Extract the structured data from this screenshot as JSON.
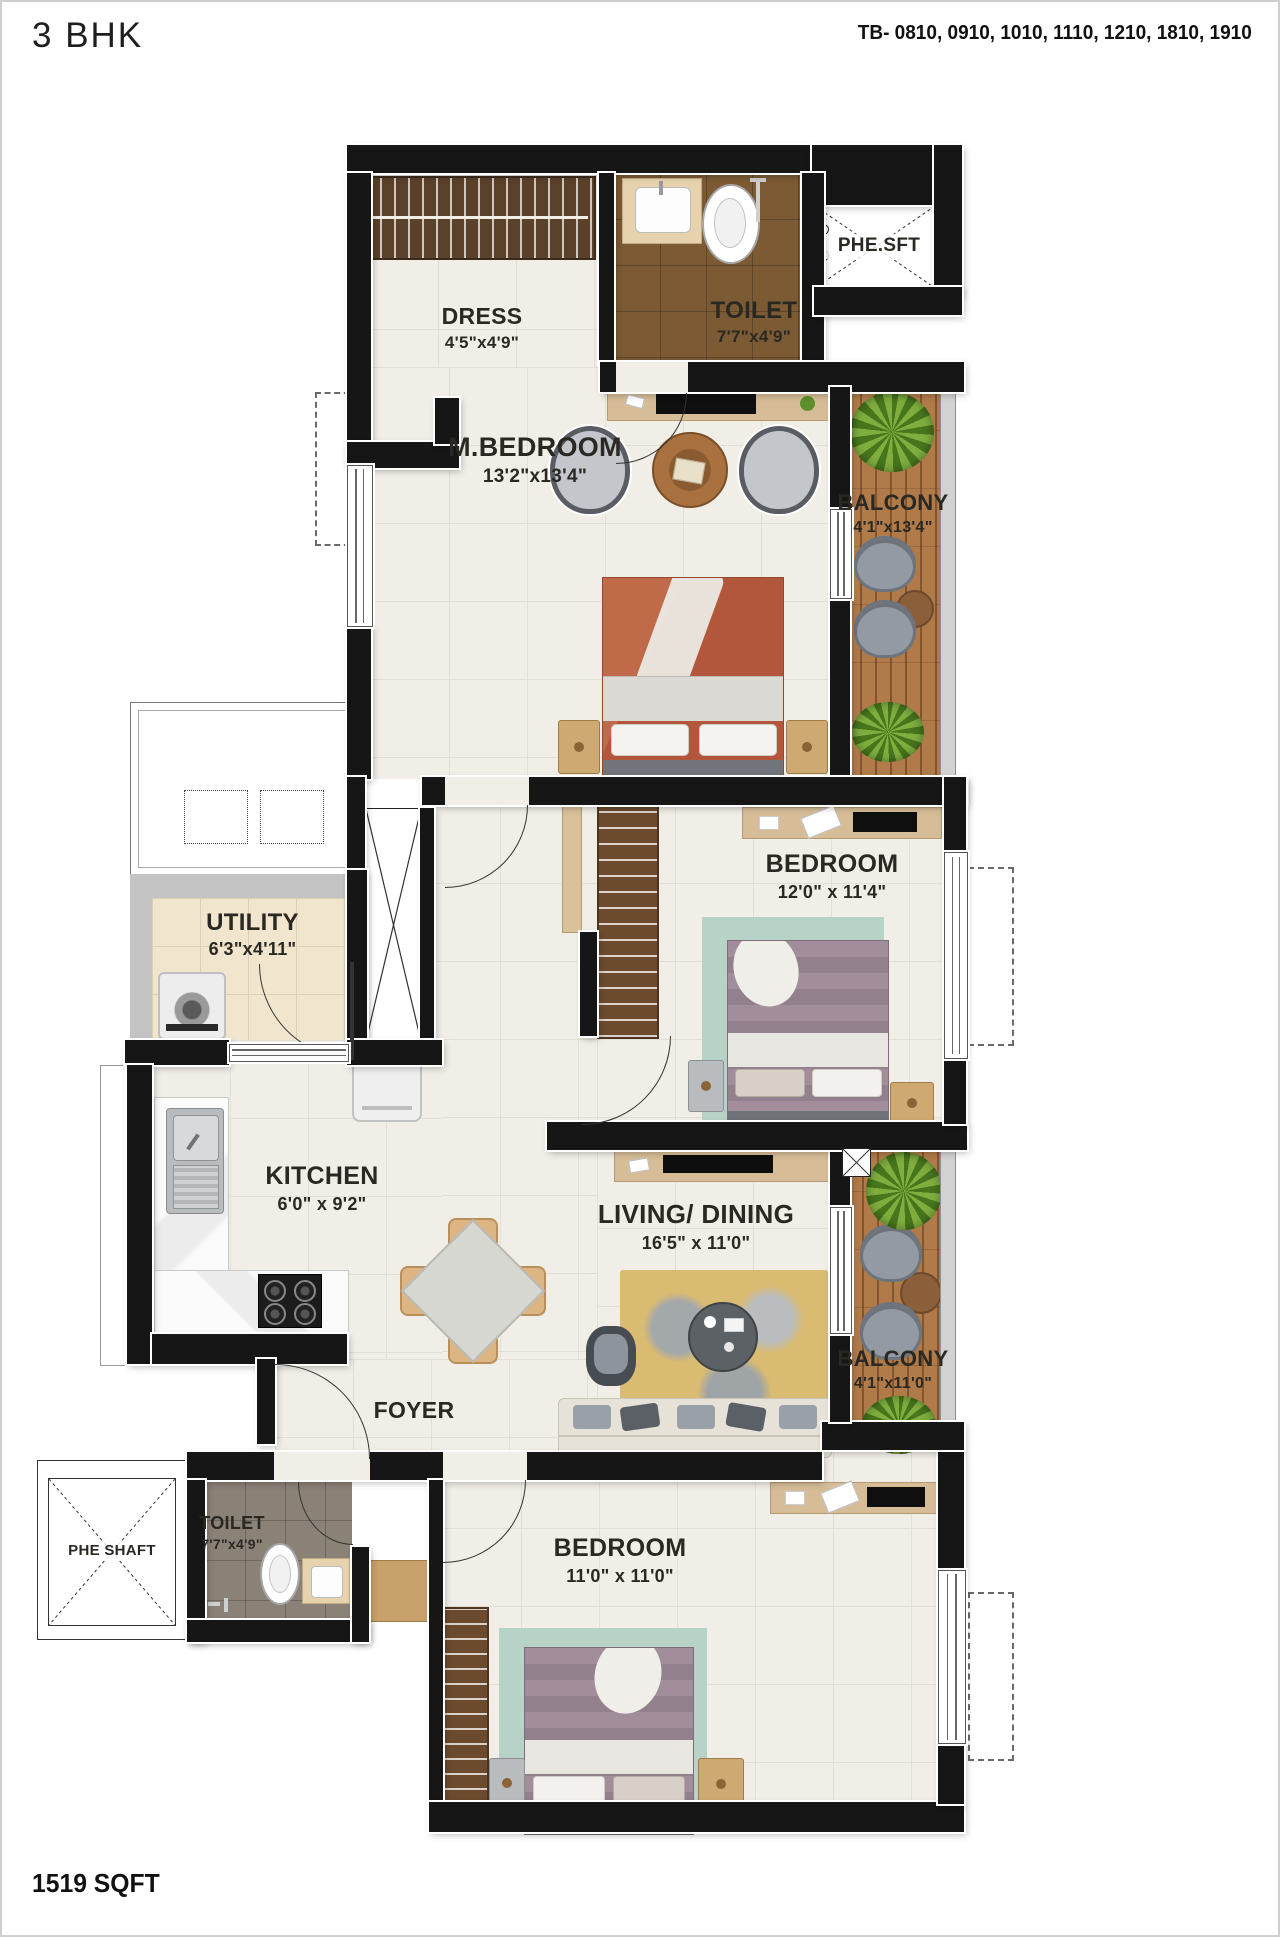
{
  "header": {
    "title": "3 BHK",
    "unit_codes": "TB- 0810, 0910, 1010, 1110, 1210, 1810, 1910"
  },
  "footer": {
    "area": "1519 SQFT"
  },
  "rooms": {
    "dress": {
      "name": "DRESS",
      "dims": "4'5\"x4'9\""
    },
    "toilet_top": {
      "name": "TOILET",
      "dims": "7'7\"x4'9\""
    },
    "phe_sft": {
      "name": "PHE.SFT"
    },
    "master_bedroom": {
      "name": "M.BEDROOM",
      "dims": "13'2\"x13'4\""
    },
    "balcony_top": {
      "name": "BALCONY",
      "dims": "4'1\"x13'4\""
    },
    "bedroom_mid": {
      "name": "BEDROOM",
      "dims": "12'0\" x 11'4\""
    },
    "utility": {
      "name": "UTILITY",
      "dims": "6'3\"x4'11\""
    },
    "kitchen": {
      "name": "KITCHEN",
      "dims": "6'0\" x 9'2\""
    },
    "living_dining": {
      "name": "LIVING/ DINING",
      "dims": "16'5\" x 11'0\""
    },
    "balcony_lower": {
      "name": "BALCONY",
      "dims": "4'1\"x11'0\""
    },
    "foyer": {
      "name": "FOYER"
    },
    "toilet_lower": {
      "name": "TOILET",
      "dims": "7'7\"x4'9\""
    },
    "phe_shaft": {
      "name": "PHE SHAFT"
    },
    "bedroom_bottom": {
      "name": "BEDROOM",
      "dims": "11'0\" x 11'0\""
    }
  },
  "colors": {
    "wall": "#161616",
    "floor_tile": "#f0eee7",
    "toilet_tile_brown": "#7b5a34",
    "toilet_tile_gray": "#8a8177",
    "utility_tile": "#f2e5cd",
    "balcony_wood": "#b07a49",
    "plant_green": "#5d8f2a",
    "bed_rust": "#b65a3c",
    "rug_teal": "#b7d2c6",
    "rug_living": "#d9bb72"
  }
}
